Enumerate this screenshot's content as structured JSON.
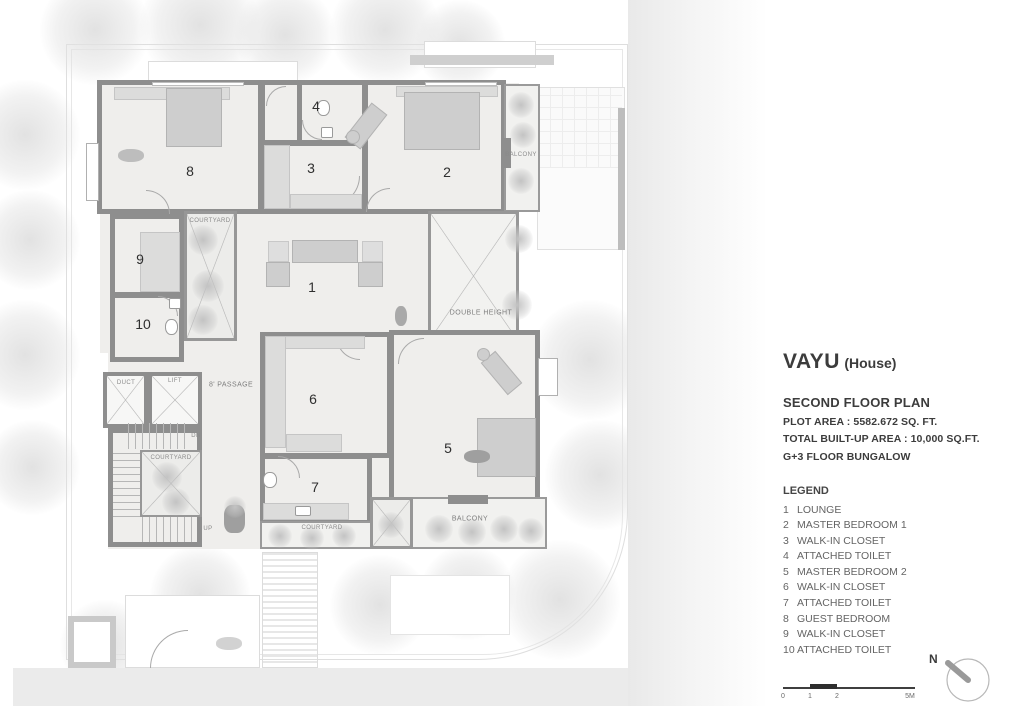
{
  "panel": {
    "title": "VAYU",
    "title_suffix": "(House)",
    "plan_name": "SECOND FLOOR PLAN",
    "plot_area": "PLOT AREA :  5582.672 SQ. FT.",
    "built_up": "TOTAL BUILT-UP AREA : 10,000 SQ.FT.",
    "floors": "G+3 FLOOR BUNGALOW",
    "legend_title": "LEGEND",
    "legend": [
      {
        "num": "1",
        "label": "LOUNGE"
      },
      {
        "num": "2",
        "label": "MASTER BEDROOM 1"
      },
      {
        "num": "3",
        "label": "WALK-IN CLOSET"
      },
      {
        "num": "4",
        "label": "ATTACHED TOILET"
      },
      {
        "num": "5",
        "label": "MASTER BEDROOM 2"
      },
      {
        "num": "6",
        "label": "WALK-IN CLOSET"
      },
      {
        "num": "7",
        "label": "ATTACHED TOILET"
      },
      {
        "num": "8",
        "label": "GUEST BEDROOM"
      },
      {
        "num": "9",
        "label": "WALK-IN CLOSET"
      },
      {
        "num": "10",
        "label": "ATTACHED TOILET"
      }
    ]
  },
  "plan": {
    "rooms": {
      "r1": "1",
      "r2": "2",
      "r3": "3",
      "r4": "4",
      "r5": "5",
      "r6": "6",
      "r7": "7",
      "r8": "8",
      "r9": "9",
      "r10": "10"
    },
    "labels": {
      "balcony_right": "BALCONY",
      "balcony_bottom": "BALCONY",
      "courtyard_top": "COURTYARD",
      "courtyard_stairs": "COURTYARD",
      "courtyard_bottom": "COURTYARD",
      "double_height": "DOUBLE HEIGHT",
      "duct": "DUCT",
      "lift": "LIFT",
      "passage": "8' PASSAGE",
      "down": "DN",
      "up": "UP"
    }
  },
  "scalebar": {
    "labels": [
      "0",
      "1",
      "2",
      "5M"
    ]
  },
  "compass": {
    "north": "N"
  },
  "colors": {
    "wall": "#8e8e8e",
    "floor": "#efeeec",
    "text_dark": "#3c3c3c",
    "text_gray": "#646464"
  }
}
